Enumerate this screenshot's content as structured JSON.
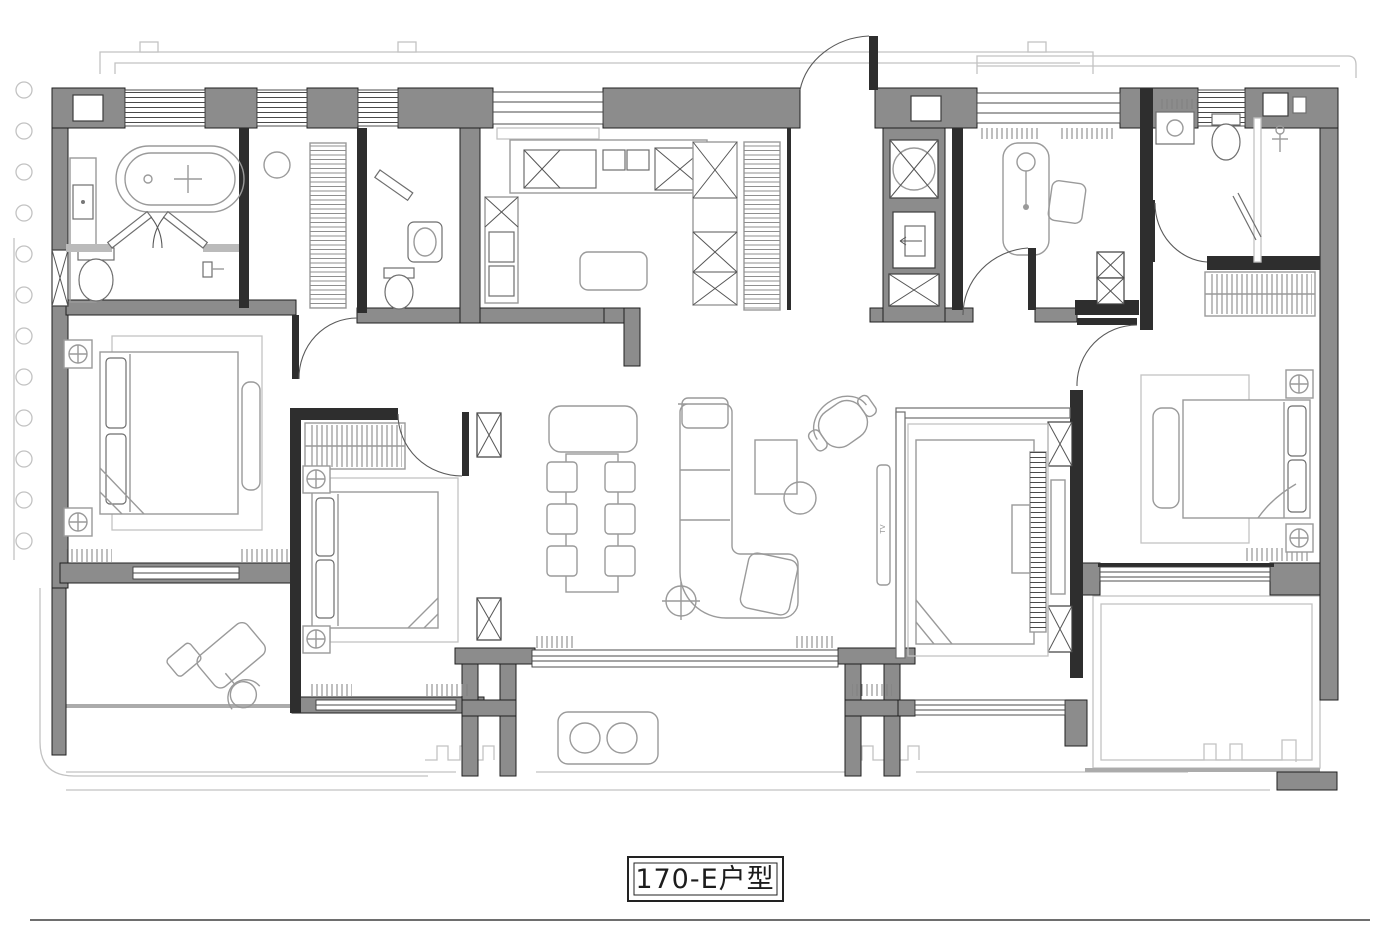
{
  "plan": {
    "unit_label": "170-E户型",
    "tv_label": "TV",
    "colors": {
      "wall": "#8c8c8c",
      "edge": "#1f1f1f",
      "partition": "#2e2e2e",
      "furn": "#9a9a9a",
      "light": "#c2c2c2"
    }
  }
}
